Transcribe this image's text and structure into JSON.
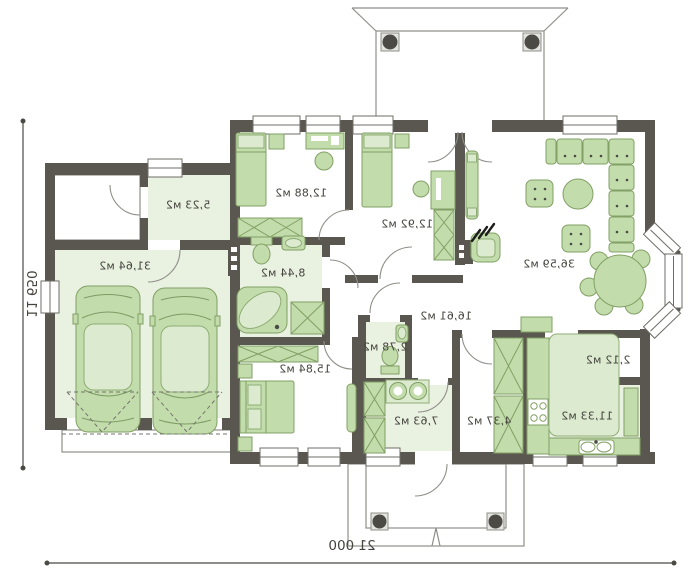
{
  "plan": {
    "type": "single-storey house floor plan (mirrored print)",
    "rooms": [
      {
        "name": "garage",
        "area": "31,64 м2"
      },
      {
        "name": "vestibule",
        "area": "5,23 м2"
      },
      {
        "name": "bedroom-1",
        "area": "12,88 м2"
      },
      {
        "name": "bedroom-2",
        "area": "12,92 м2"
      },
      {
        "name": "living-room",
        "area": "36,59 м2"
      },
      {
        "name": "bathroom",
        "area": "8,44 м2"
      },
      {
        "name": "bedroom-3",
        "area": "15,84 м2"
      },
      {
        "name": "hall",
        "area": "16,61 м2"
      },
      {
        "name": "wc",
        "area": "2,78 м2"
      },
      {
        "name": "laundry",
        "area": "7,63 м2"
      },
      {
        "name": "wardrobe",
        "area": "4,37 м2"
      },
      {
        "name": "kitchen",
        "area": "11,33 м2"
      },
      {
        "name": "pantry",
        "area": "2,12 м2"
      }
    ],
    "dimensions": {
      "overall_width": "21 000",
      "overall_height": "11 650"
    },
    "colors": {
      "wall": "#59574f",
      "room_fill": "#e9f1e1",
      "furniture_fill": "#c2dcab",
      "furniture_outline": "#82a065",
      "text": "#45443e"
    },
    "icons": [
      "car-icon",
      "bed-icon",
      "sofa-icon",
      "armchair-icon",
      "coffee-table-icon",
      "dining-table-icon",
      "bathtub-icon",
      "shower-icon",
      "toilet-icon",
      "washbasin-icon",
      "stove-icon",
      "kitchen-sink-icon",
      "wardrobe-icon",
      "fireplace-icon",
      "radiator-icon",
      "column-icon",
      "desk-icon",
      "chair-icon"
    ]
  }
}
